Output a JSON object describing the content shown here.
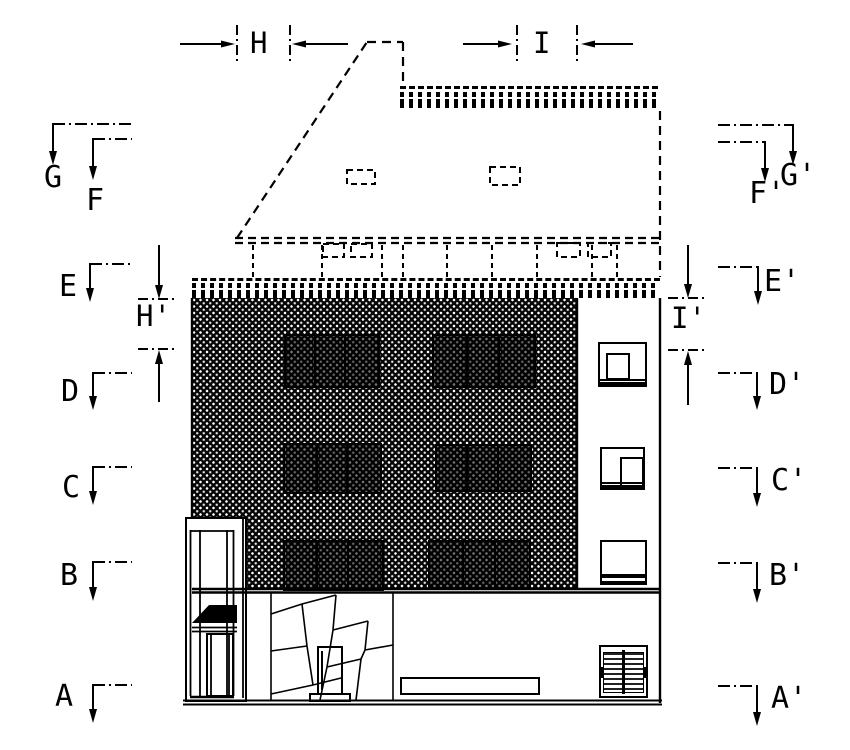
{
  "colors": {
    "ink": "#000000",
    "paper": "#ffffff"
  },
  "section_markers": {
    "left": {
      "G": "G",
      "F": "F",
      "E": "E",
      "D": "D",
      "C": "C",
      "B": "B",
      "A": "A"
    },
    "right": {
      "G": "G'",
      "F": "F'",
      "E": "E'",
      "D": "D'",
      "C": "C'",
      "B": "B'",
      "A": "A'"
    }
  },
  "dimensions": {
    "H": "H",
    "I": "I",
    "H_prime": "H'",
    "I_prime": "I'"
  }
}
